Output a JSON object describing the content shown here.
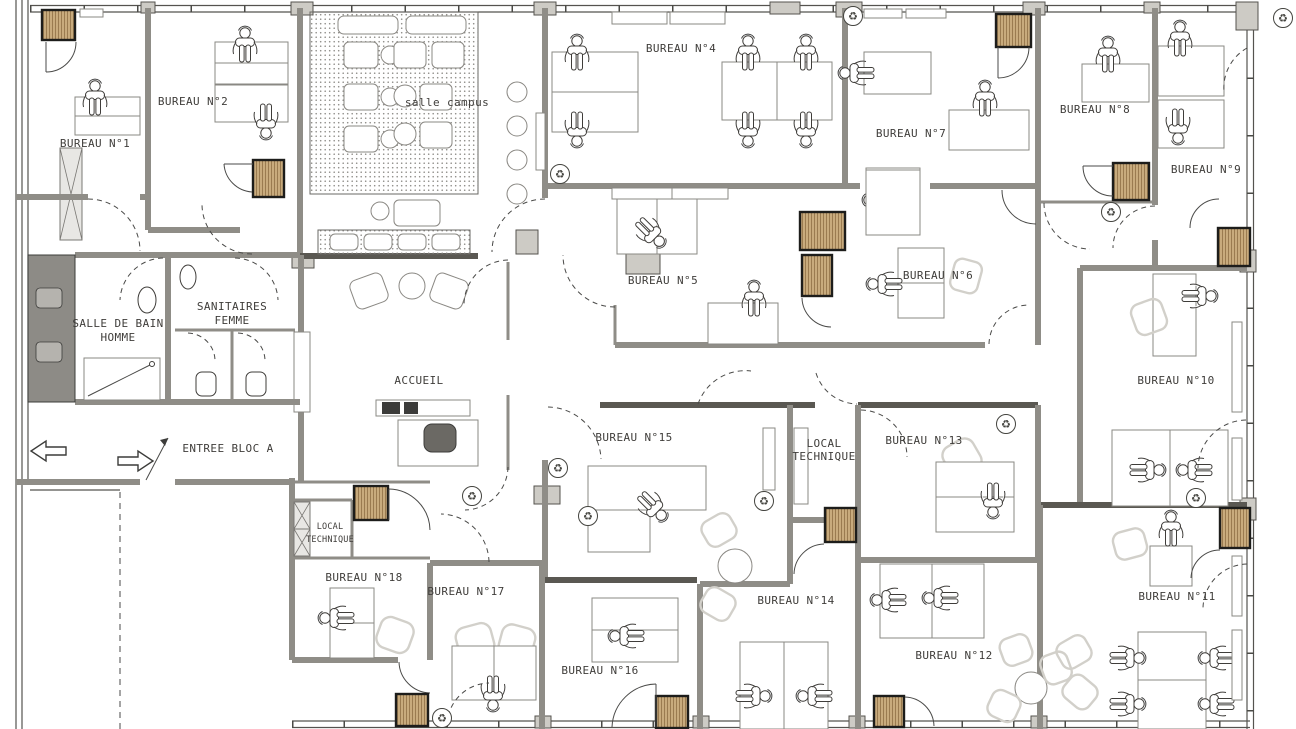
{
  "labels": {
    "bureau1": "BUREAU N°1",
    "bureau2": "BUREAU N°2",
    "bureau4": "BUREAU N°4",
    "bureau5": "BUREAU N°5",
    "bureau6": "BUREAU N°6",
    "bureau7": "BUREAU N°7",
    "bureau8": "BUREAU N°8",
    "bureau9": "BUREAU N°9",
    "bureau10": "BUREAU N°10",
    "bureau11": "BUREAU N°11",
    "bureau12": "BUREAU N°12",
    "bureau13": "BUREAU N°13",
    "bureau14": "BUREAU N°14",
    "bureau15": "BUREAU N°15",
    "bureau16": "BUREAU N°16",
    "bureau17": "BUREAU N°17",
    "bureau18": "BUREAU N°18",
    "salle_campus": "salle campus",
    "salle_de_bain_line1": "SALLE DE BAIN",
    "salle_de_bain_line2": "HOMME",
    "sanitaires_line1": "SANITAIRES",
    "sanitaires_line2": "FEMME",
    "entree": "ENTREE BLOC A",
    "accueil": "ACCUEIL",
    "local_technique_line1": "LOCAL",
    "local_technique_line2": "TECHNIQUE"
  },
  "icons": {
    "recycle": "♻"
  },
  "colors": {
    "wood": "#c8ab7d",
    "wood_dark": "#9a7b50",
    "wall": "#8f8d87",
    "wall_dark": "#5a5852",
    "pier": "#cdcbc5",
    "shaft": "#8d8b86",
    "line": "#3f3d3a",
    "light": "#d2d0ca",
    "stipple": "#8f8d89"
  }
}
